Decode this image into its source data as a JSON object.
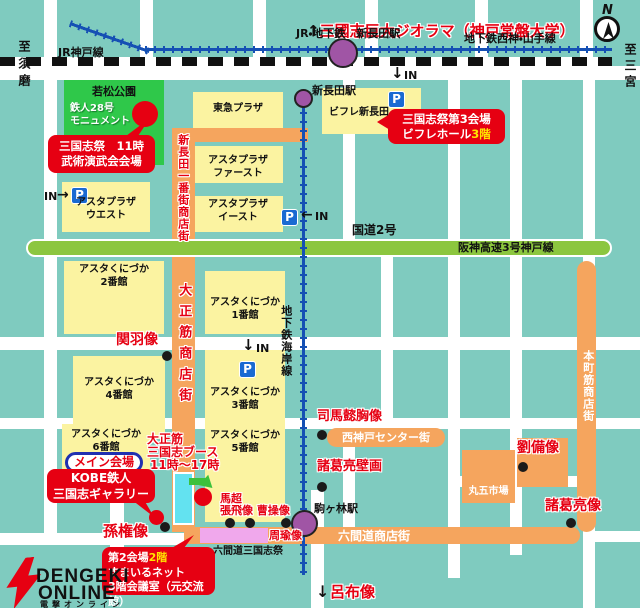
{
  "header": {
    "arrow_up": "↑",
    "diorama_title": "三國志巨大ジオラマ（神戸常盤大学）",
    "jr_subway_station": "JR・地下鉄　新長田駅",
    "seishin_yamate_line": "地下鉄西神・山手線",
    "jr_kobe_line": "JR神戸線",
    "to_suma": "至須磨",
    "to_sannomiya": "至三宮",
    "compass_n": "N"
  },
  "stations": {
    "shinnagata": "新長田駅",
    "komagabayashi": "駒ヶ林駅",
    "kaigan_line": "地下鉄海岸線"
  },
  "roads": {
    "route2": "国道2号",
    "hanshin_expressway": "阪神高速3号神戸線"
  },
  "streets": {
    "ichibangai": "新長田一番街商店街",
    "taishosuji": "大正筋商店街",
    "rokkendo": "六間道商店街",
    "nishikobe_center": "西神戸センター街",
    "honmachisuji": "本町筋商店街"
  },
  "buildings": {
    "wakamatsu_park": "若松公園",
    "tetsujin_monument": "鉄人28号\nモニュメント",
    "tokyu_plaza": "東急プラザ",
    "bifure_shinnagata": "ビフレ新長田",
    "asta_plaza_first": "アスタプラザ\nファースト",
    "asta_plaza_west": "アスタプラザ\nウエスト",
    "asta_plaza_east": "アスタプラザ\nイースト",
    "kunizuka_1": "アスタくにづか\n1番館",
    "kunizuka_2": "アスタくにづか\n2番館",
    "kunizuka_3": "アスタくにづか\n3番館",
    "kunizuka_4": "アスタくにづか\n4番館",
    "kunizuka_5": "アスタくにづか\n5番館",
    "kunizuka_6": "アスタくにづか\n6番館",
    "maruko_market": "丸五市場"
  },
  "venues": {
    "bujutsu": {
      "line1": "三国志祭　11時",
      "line2": "武術演武会会場"
    },
    "third_venue": {
      "line1": "三国志祭第3会場",
      "line2": "ビフレホール",
      "floor": "3階"
    },
    "main_venue_label": "メイン会場",
    "gallery": {
      "line1": "KOBE鉄人",
      "line2": "三国志ギャラリー"
    },
    "second_venue": {
      "line1": "第2会場",
      "floor": "2階",
      "line2": "すまいるネット",
      "line3": "3階会議室（元交流館）"
    },
    "taisho_booth": {
      "line1": "大正筋",
      "line2": "三国志ブース",
      "line3": "11時〜17時"
    },
    "rokkendo_festival": "六間道三国志祭"
  },
  "statues": {
    "kanu": "関羽像",
    "sonken": "孫権像",
    "basho": "馬超",
    "chohi_soso": "張飛像 曹操像",
    "shuyu": "周瑜像",
    "shibai": "司馬懿胸像",
    "shokatsuryo_mural": "諸葛亮壁画",
    "ryubi": "劉備像",
    "shokatsuryo": "諸葛亮像",
    "ryofu": "呂布像"
  },
  "icons": {
    "parking": "P",
    "in_label": "IN",
    "arrow_down": "↓",
    "arrow_left": "←",
    "arrow_right": "→"
  },
  "logo": {
    "line1": "DENGEKI",
    "line2": "ONLINE",
    "line3": "電撃オンライン"
  },
  "colors": {
    "background": "#7fcbbf",
    "building_yellow": "#fbf3a1",
    "park_green": "#2fc84a",
    "street_orange": "#f5a55e",
    "expressway_green": "#8cc63f",
    "accent_red": "#e60012",
    "station_purple": "#a055a5",
    "parking_blue": "#1a6ad2",
    "rail_blue": "#1550b4",
    "highlight_yellow": "#ffe400",
    "gallery_cyan": "#63e2f0",
    "festival_pink": "#f0a8ec"
  }
}
